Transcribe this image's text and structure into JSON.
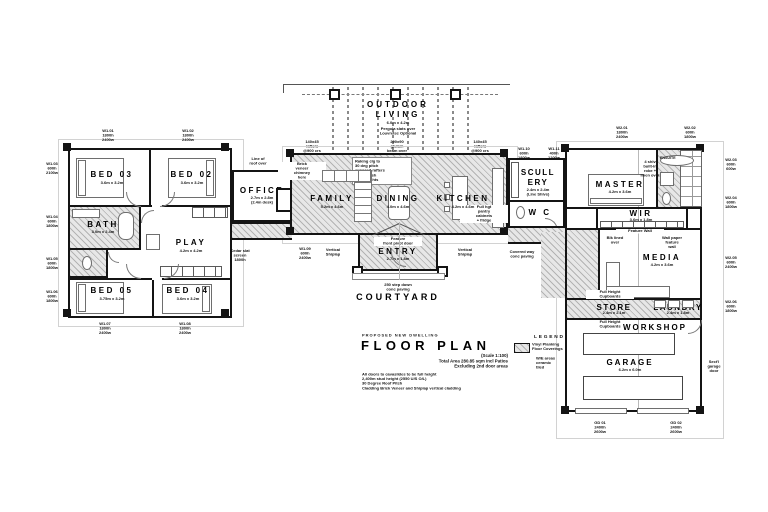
{
  "title": {
    "overline": "PROPOSED NEW DWELLING",
    "main": "FLOOR PLAN",
    "sub": "(Scale 1:100)\nTotal Area 280.85 sqm incl Patios\nExcluding 2nd door areas",
    "notes": "All doors to cavaslides to be full height\n2,400m stud height (2550 U/S O/L)\n30 Degree Roof Pitch\nCladding Brick Veneer and Shiplap vertical cladding"
  },
  "legend": {
    "heading": "LEGEND",
    "swatch_label": "Vinyl Planking\nFloor Coverings",
    "note": "W/E areas\nceramic\ntiled"
  },
  "outdoor": {
    "line1": "OUTDOOR",
    "line2": "LIVING",
    "dims": "6.0m x 4.2m",
    "note": "Pergola slats over\nLouvretec Optional"
  },
  "rooms": {
    "bed03": {
      "name": "BED 03",
      "dims": "3.6m x 3.2m"
    },
    "bed02": {
      "name": "BED 02",
      "dims": "3.6m x 3.2m"
    },
    "bath": {
      "name": "BATH",
      "dims": "3.0m x 2.4m"
    },
    "play": {
      "name": "PLAY",
      "dims": "4.2m x 4.2m"
    },
    "bed05": {
      "name": "BED 05",
      "dims": "3.75m x 3.2m"
    },
    "bed04": {
      "name": "BED 04",
      "dims": "3.6m x 3.2m"
    },
    "office": {
      "name": "OFFICE",
      "dims": "2.7m x 2.8m\n(2.4m desk)"
    },
    "family": {
      "name": "FAMILY",
      "dims": "5.2m x 4.6m"
    },
    "dining": {
      "name": "DINING",
      "dims": "4.0m x 4.6m"
    },
    "kitchen": {
      "name": "KITCHEN",
      "dims": "4.2m x 4.6m"
    },
    "scullery": {
      "name": "SCULL\nERY",
      "dims": "2.4m x 2.4m\n(Line Shlvs)"
    },
    "wc": {
      "name": "W C"
    },
    "entry": {
      "name": "ENTRY",
      "dims": "2.7m x 1.8m"
    },
    "courtyard": {
      "name": "COURTYARD"
    },
    "master": {
      "name": "MASTER",
      "dims": "4.2m x 3.6m"
    },
    "ensuite": {
      "name": "ENSUITE"
    },
    "wir": {
      "name": "WIR",
      "dims": "3.6m x 1.8m"
    },
    "media": {
      "name": "MEDIA",
      "dims": "4.2m x 3.6m"
    },
    "store": {
      "name": "STORE",
      "dims": "2.4m x 2.1m"
    },
    "laundry": {
      "name": "LAUNDRY",
      "dims": "2.4m x 1.8m"
    },
    "workshop": {
      "name": "WORKSHOP"
    },
    "garage": {
      "name": "GARAGE",
      "dims": "6.2m x 6.0m"
    }
  },
  "notes": {
    "roof_over": "Line of\nroof over",
    "ceiling": "Raking clg to\n30 deg pitch\nexposed rafters\npaint finish\nno skylights",
    "chimney": "Brick\nveneer\nchimney\nhere",
    "rafters_l": "140x45\nrafters\n@900 crs\nstained",
    "beam": "290x90\nglulam\nbeam over",
    "rafters_r": "140x45\nrafters\n@900 crs\nstained",
    "pantry": "Full hgt\npantry\ncabinets\n+ fridge",
    "pivot": "Feature\nfront pivot door",
    "shiplap_l": "Vertical\nShiplap",
    "shiplap_r": "Vertical\nShiplap",
    "step": "250 step down\nconc paving",
    "robe_over": "4 shlv\nbuilt-in\nrobe +\nlinen over",
    "feature_wall": "Feature Wall",
    "blk_over": "Blk lined\nover",
    "wallpaper": "Wall paper\nfeature\nwall",
    "cup_top": "Full Height\nCupboards",
    "cup_bot": "Full Height\nCupboards",
    "garage_door": "Sect'l\ngarage\ndoor"
  },
  "win": [
    "W1.01\n1800h\n2400w",
    "W1.02\n1800h\n2400w",
    "W1.03\n600h\n2100w",
    "W1.04\n600h\n1800w",
    "W1.05\n600h\n1800w",
    "W1.06\n600h\n1800w",
    "W1.07\n1800h\n2400w",
    "W1.08\n1800h\n2400w",
    "Cedar slat\nscreen\n1800h",
    "W1.09\n600h\n2400w",
    "W1.10\n600h\n1800w",
    "W1.11\n400h\n1200w",
    "Covered way\nconc paving",
    "W2.01\n1800h\n2400w",
    "W2.02\n600h\n1800w",
    "W2.03\n600h\n600w",
    "W2.04\n600h\n1800w",
    "W2.05\n600h\n2400w",
    "W2.06\n600h\n1800w",
    "GD 01\n2400h\n2600w",
    "GD 02\n2400h\n2600w"
  ]
}
